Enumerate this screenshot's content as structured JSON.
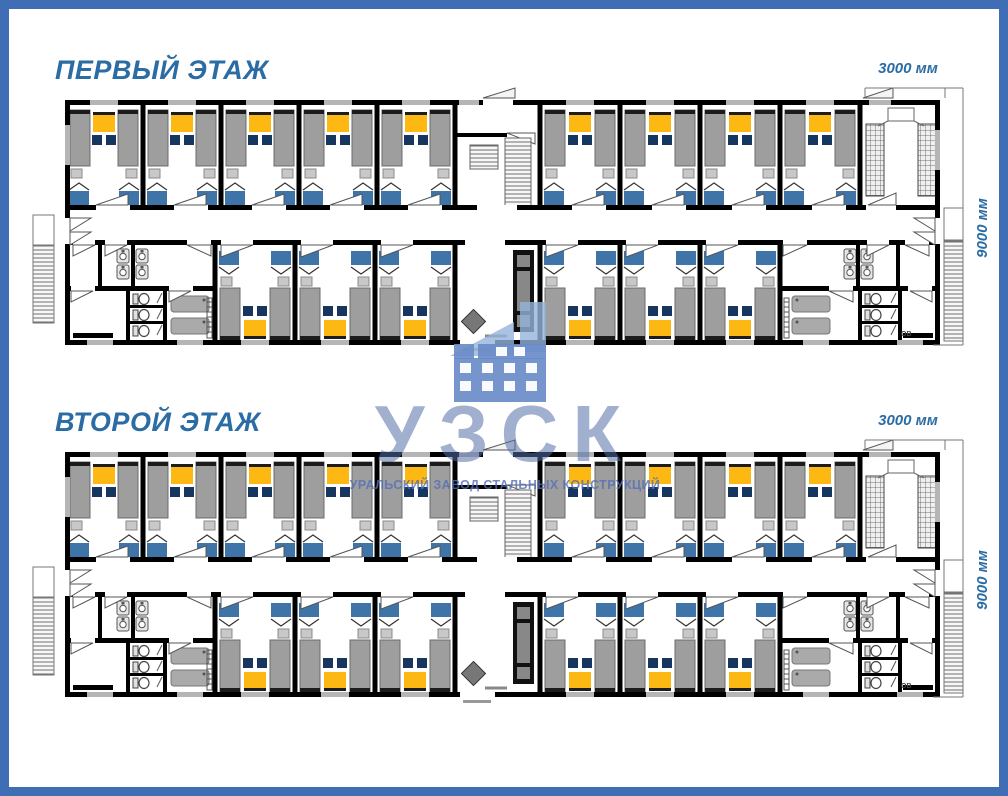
{
  "theme": {
    "frame_color": "#3f6eb5",
    "title_color": "#2a6ca3",
    "dim_color": "#2a6ca3",
    "wm_text_color": "rgba(86,112,168,0.55)",
    "wm_subtitle_color": "rgba(85,110,180,0.8)",
    "wm_icon_color": "rgba(105,140,200,0.92)",
    "wm_swoosh_color": "rgba(150,180,220,0.8)"
  },
  "watermark": {
    "logo_text": "УЗСК",
    "subtitle": "УРАЛЬСКИЙ ЗАВОД СТАЛЬНЫХ КОНСТРУКЦИЙ",
    "icon": "building-icon"
  },
  "floors": [
    {
      "id": "floor-1",
      "title": "ПЕРВЫЙ ЭТАЖ",
      "dim_width_label": "3000 мм",
      "dim_depth_label": "9000 мм",
      "vent_label": "ОВ"
    },
    {
      "id": "floor-2",
      "title": "ВТОРОЙ ЭТАЖ",
      "dim_width_label": "3000 мм",
      "dim_depth_label": "9000 мм",
      "vent_label": "ОВ"
    }
  ],
  "plan": {
    "colors": {
      "wall": "#000000",
      "floor": "#ffffff",
      "bed": "#9e9e9e",
      "bed_border": "#6b6b6b",
      "headboard": "#1c1c1c",
      "table": "#fdb813",
      "chair": "#16365f",
      "wardrobe": "#3e74a8",
      "stool": "#c8c8c8",
      "window": "#b5b5b5",
      "fixture_fill": "#e6e6e6",
      "fixture_stroke": "#555555",
      "shower": "#aaaaaa",
      "mat": "#000000",
      "cabinet": "#111111",
      "cabinet_inner": "#888888",
      "diamond": "#777777",
      "door_stroke": "#555555",
      "hatch_stroke": "#777777"
    },
    "layout": {
      "rooms_top_left": 5,
      "rooms_top_right": 4,
      "rooms_bottom_left": 3,
      "rooms_bottom_right": 3,
      "beds_per_room": 2,
      "wardrobes_per_room": 2,
      "wc_stalls_per_block": 3,
      "showers_per_block": 2,
      "sinks_per_room": 2
    }
  }
}
